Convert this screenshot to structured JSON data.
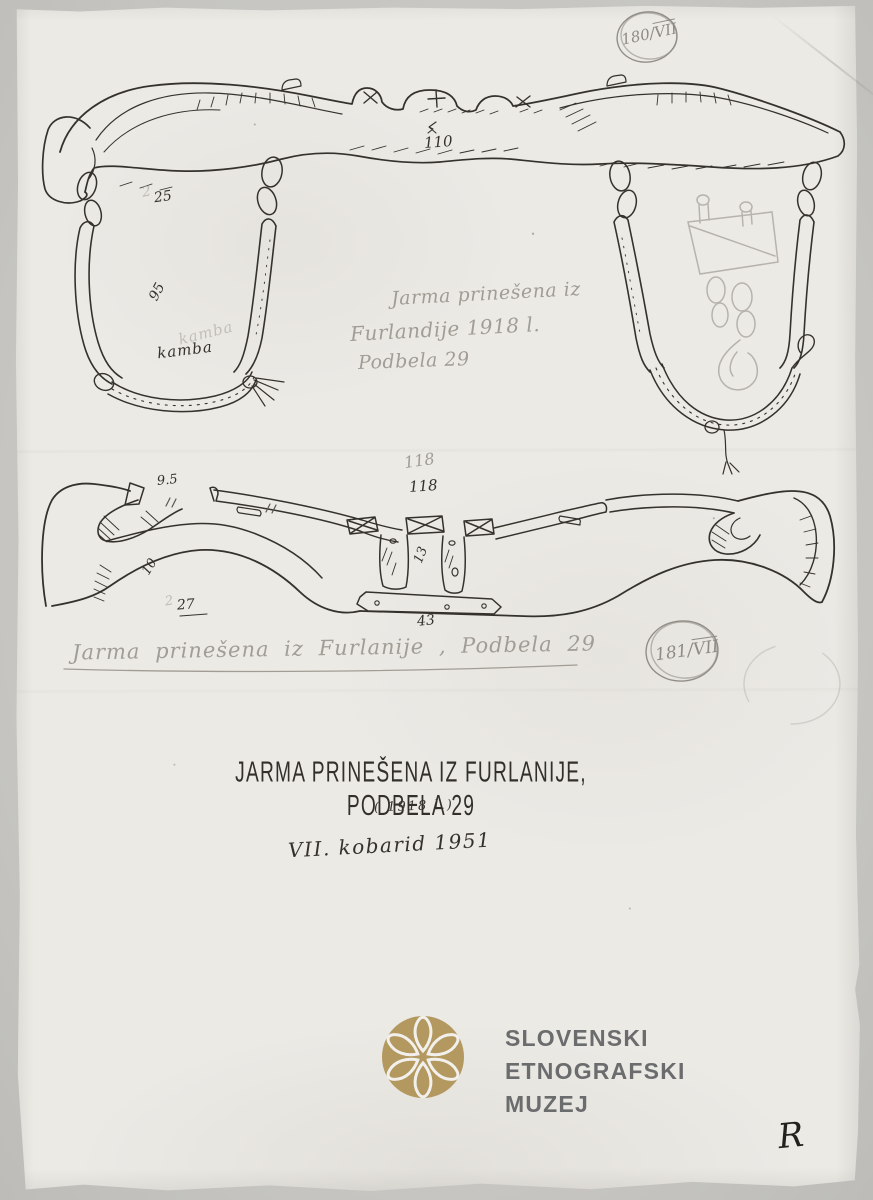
{
  "document": {
    "type_note": "scanned museum drawing sheet",
    "stamps": {
      "top": {
        "number": "180/",
        "roman": "VII"
      },
      "bottom": {
        "number": "181/",
        "roman": "VII"
      }
    },
    "drawing1": {
      "length_label": "110",
      "width_label": "25",
      "bow_label": "95",
      "faint_digit": "2",
      "part_label_ink": "kamba",
      "part_label_pencil": "kamba",
      "pencil_note": {
        "line1": "Jarma prinešena iz",
        "line2": "Furlandije 1918 l.",
        "line3": "Podbela 29"
      }
    },
    "drawing2": {
      "length_pencil": "118",
      "length_ink": "118",
      "height_label": "9.5",
      "thickness_label": "10",
      "width_label": "27",
      "faint_digit": "2",
      "peg_label": "13",
      "strap_label": "43",
      "pencil_caption": "Jarma prinešena iz Furlanije , Podbela 29"
    },
    "caption": {
      "title": "JARMA PRINEŠENA IZ FURLANIJE, PODBELA 29",
      "year": "( 1918 l.)",
      "place_date": "VII. kobarid 1951"
    },
    "logo": {
      "line1": "SLOVENSKI",
      "line2": "ETNOGRAFSKI",
      "line3": "MUZEJ",
      "gold": "#b3985f",
      "text_color": "#6b6c6e"
    },
    "signature": "R",
    "colors": {
      "paper": "#ECEAE5",
      "backdrop": "#c9c8c4",
      "ink": "#35322c",
      "pencil": "#a19d95"
    }
  }
}
